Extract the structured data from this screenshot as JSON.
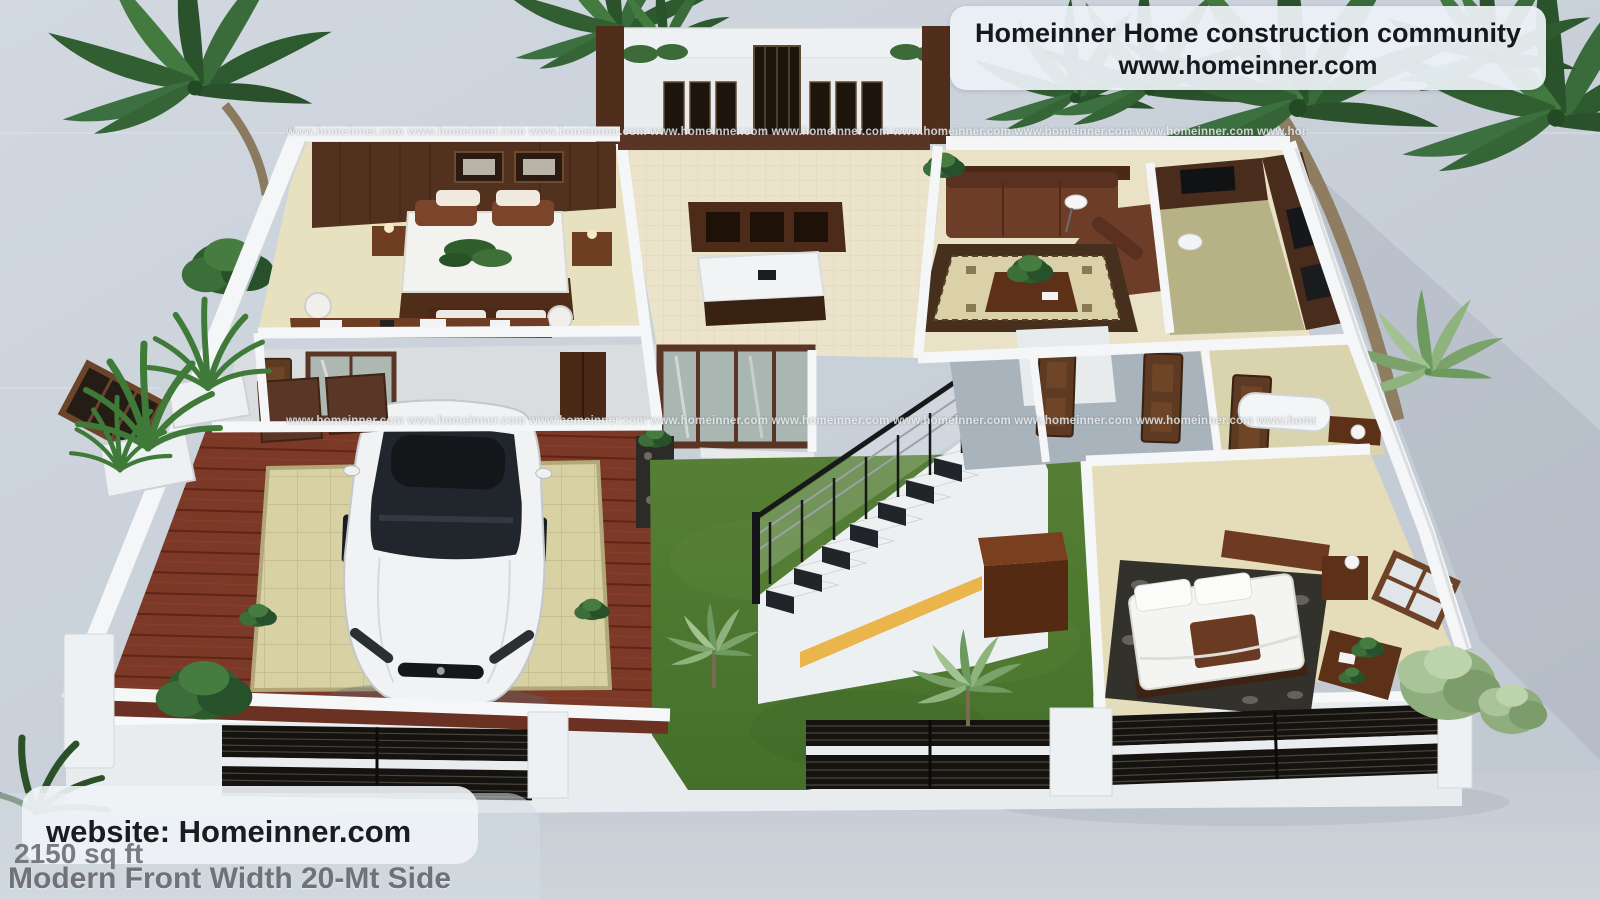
{
  "banner": {
    "line1": "Homeinner Home construction community",
    "line2": "www.homeinner.com"
  },
  "watermark": {
    "row": "www.homeinner.com www.homeinner.com www.homeinner.com www.homeinner.com www.homeinner.com www.homeinner.com www.homeinner.com www.homeinner.com www.homeinner.com www.homeinner.com www.homeinner.com"
  },
  "footer": {
    "website": "website: Homeinner.com",
    "area": "2150 sq ft",
    "plan": "Modern Front Width 20-Mt Side"
  },
  "scene": {
    "type": "3d-floorplan-render",
    "colors": {
      "sky": "#c9d1da",
      "wall": "#f3f5f6",
      "lawn": "#4e7a30",
      "wood_floor": "#7c3a29",
      "tile_floor": "#e7e0bf",
      "dark_wood": "#573523",
      "sofa_leather": "#6e3d27",
      "car_body": "#f0f2f3",
      "fence_panel": "#17140f",
      "stair_glow": "#eab54b"
    }
  }
}
